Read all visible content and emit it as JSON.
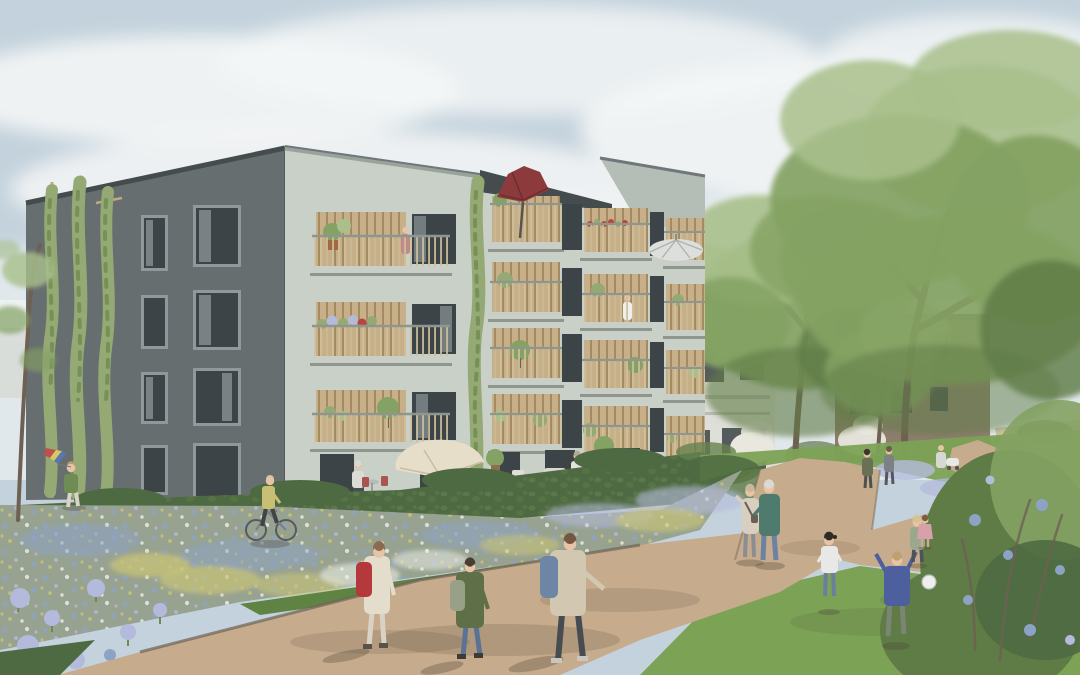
{
  "scene": {
    "title": "Residential courtyard architectural rendering",
    "description": "Photorealistic visualization of a modern five-storey apartment building with timber-clad loggia balconies, set in a landscaped park with gravel paths, flower meadows, lawns, mature trees and people enjoying the outdoor space",
    "time_of_day": "daytime, light clouds",
    "text_visible": "none"
  },
  "colors": {
    "sky_top": "#c3d2dc",
    "sky_low": "#e6ecef",
    "cloud": "#f4f6f6",
    "facade_dark": "#676e70",
    "facade_cap": "#454c4e",
    "facade_sage": "#c8d0c7",
    "facade_sage_shade": "#b4bdb6",
    "wood": "#c7b089",
    "wood_dark": "#a3895f",
    "rail": "#cfc09a",
    "slab": "#c9cec7",
    "slab_shadow": "#8e968e",
    "window_dark": "#3d4448",
    "window_frame": "#8f989a",
    "glass": "#aab3b6",
    "umbrella_red": "#8d3a3d",
    "umbrella_white": "#dcdfdb",
    "parasol_cream": "#e7deca",
    "vine": "#95a975",
    "vine_dark": "#6e8a50",
    "tree_light": "#a9c08c",
    "tree_mid": "#84a263",
    "tree_dark": "#5f7b46",
    "trunk": "#6e6052",
    "hedge": "#4e6a42",
    "hedge_light": "#66814f",
    "lawn": "#7ca256",
    "lawn_dark": "#5e8343",
    "meadow": "#97a290",
    "flower_blue": "#8da3c6",
    "flower_lavender": "#b4badb",
    "flower_white": "#eaece4",
    "flower_yellow": "#c7c377",
    "flower_red": "#b8453f",
    "path": "#c6ab8c",
    "path_dark": "#a88f73",
    "path_edge": "#6e6354",
    "building_brown": "#8d7d6d",
    "building_white": "#dddfd8",
    "blossom": "#e9e7de",
    "skin": "#e7c4a6",
    "shadow": "#4a4334",
    "ball": "#edefec"
  },
  "buildings": [
    {
      "id": "main",
      "label": "main apartment building",
      "floors": 5,
      "facades": [
        {
          "side": "left",
          "finish": "dark grey render",
          "features": [
            "grid of windows",
            "three climbing green facade vines on trellis poles"
          ]
        },
        {
          "side": "front",
          "finish": "pale sage render",
          "features": [
            "timber-clad loggias",
            "slatted wood balcony railings",
            "balcony plants and flower boxes",
            "dark red umbrella on top balcony",
            "pale umbrella on right balcony",
            "red geranium boxes",
            "ground floor terraces with cream parasol"
          ]
        }
      ]
    },
    {
      "id": "rear_white",
      "label": "background building with timber pergola",
      "finish": "off-white render"
    },
    {
      "id": "rear_brown",
      "label": "background building behind trees",
      "finish": "brown render"
    }
  ],
  "landscape": {
    "paths": "Y-shaped light gravel paths crossing the park",
    "meadow": "wildflower meadow with blue, lavender, white and yellow drifts",
    "lawn": "mown lawn on the right where children play",
    "hedge": "clipped hedge row in front of the building terraces",
    "trees": [
      "large park tree right",
      "park tree centre-right",
      "young tree far left",
      "white blossoming shrubs",
      "dark shrub with blue alliums bottom right"
    ]
  },
  "people": [
    {
      "name": "kite-child",
      "activity": "running with rainbow kite",
      "colors": {
        "shirt": "#6f8c55"
      }
    },
    {
      "name": "cyclist",
      "activity": "riding bicycle past the meadow",
      "colors": {
        "top": "#c9bf74"
      }
    },
    {
      "name": "schoolgirl",
      "activity": "walking on path",
      "colors": {
        "jacket": "#e5ddcb",
        "backpack": "#b5383d",
        "pants": "#d9d3c5"
      }
    },
    {
      "name": "child-green",
      "activity": "walking on path",
      "colors": {
        "jacket": "#5f6f48",
        "backpack": "#98a088",
        "jeans": "#5a7296"
      }
    },
    {
      "name": "boy-hoodie",
      "activity": "walking on path",
      "colors": {
        "hoodie": "#d2c7b0",
        "backpack": "#6e86a6",
        "pants": "#474c52"
      }
    },
    {
      "name": "terrace-man",
      "activity": "standing at terrace bistro table",
      "colors": {
        "shirt": "#dcdcd6"
      }
    },
    {
      "name": "terrace-neighbor",
      "activity": "standing on right terrace",
      "colors": {
        "shirt": "#e2e2de"
      }
    },
    {
      "name": "grandmother",
      "activity": "standing on path pointing",
      "colors": {
        "top": "#d9cfc0",
        "pants": "#8a8d92"
      }
    },
    {
      "name": "grandfather",
      "activity": "standing on path",
      "colors": {
        "shirt": "#4f7a6e",
        "jeans": "#6b82a2"
      }
    },
    {
      "name": "girl-white-shirt",
      "activity": "playing on lawn",
      "colors": {
        "top": "#e8e8e6",
        "jeans": "#6a7fa0"
      }
    },
    {
      "name": "boy-playing-ball",
      "activity": "arms up playing ball",
      "colors": {
        "shirt": "#4d5f9c",
        "pants": "#7a8574"
      }
    },
    {
      "name": "blond-child",
      "activity": "playing on lawn",
      "colors": {
        "top": "#9aa88e"
      }
    },
    {
      "name": "walker-a",
      "activity": "strolling on back path",
      "colors": {
        "outfit": "#6a7055"
      }
    },
    {
      "name": "walker-b",
      "activity": "strolling on back path",
      "colors": {
        "outfit": "#7c8186"
      }
    },
    {
      "name": "pram-walker",
      "activity": "pushing pram on far path",
      "colors": {
        "outfit": "#d8d8d2"
      }
    },
    {
      "name": "toddler-pink",
      "activity": "on far right path",
      "colors": {
        "dress": "#d8a0a8"
      }
    },
    {
      "name": "balcony-resident-a",
      "activity": "standing on balcony",
      "colors": {
        "top": "#c08a8a"
      }
    },
    {
      "name": "balcony-resident-b",
      "activity": "standing on balcony",
      "colors": {
        "dress": "#efefec"
      }
    }
  ]
}
